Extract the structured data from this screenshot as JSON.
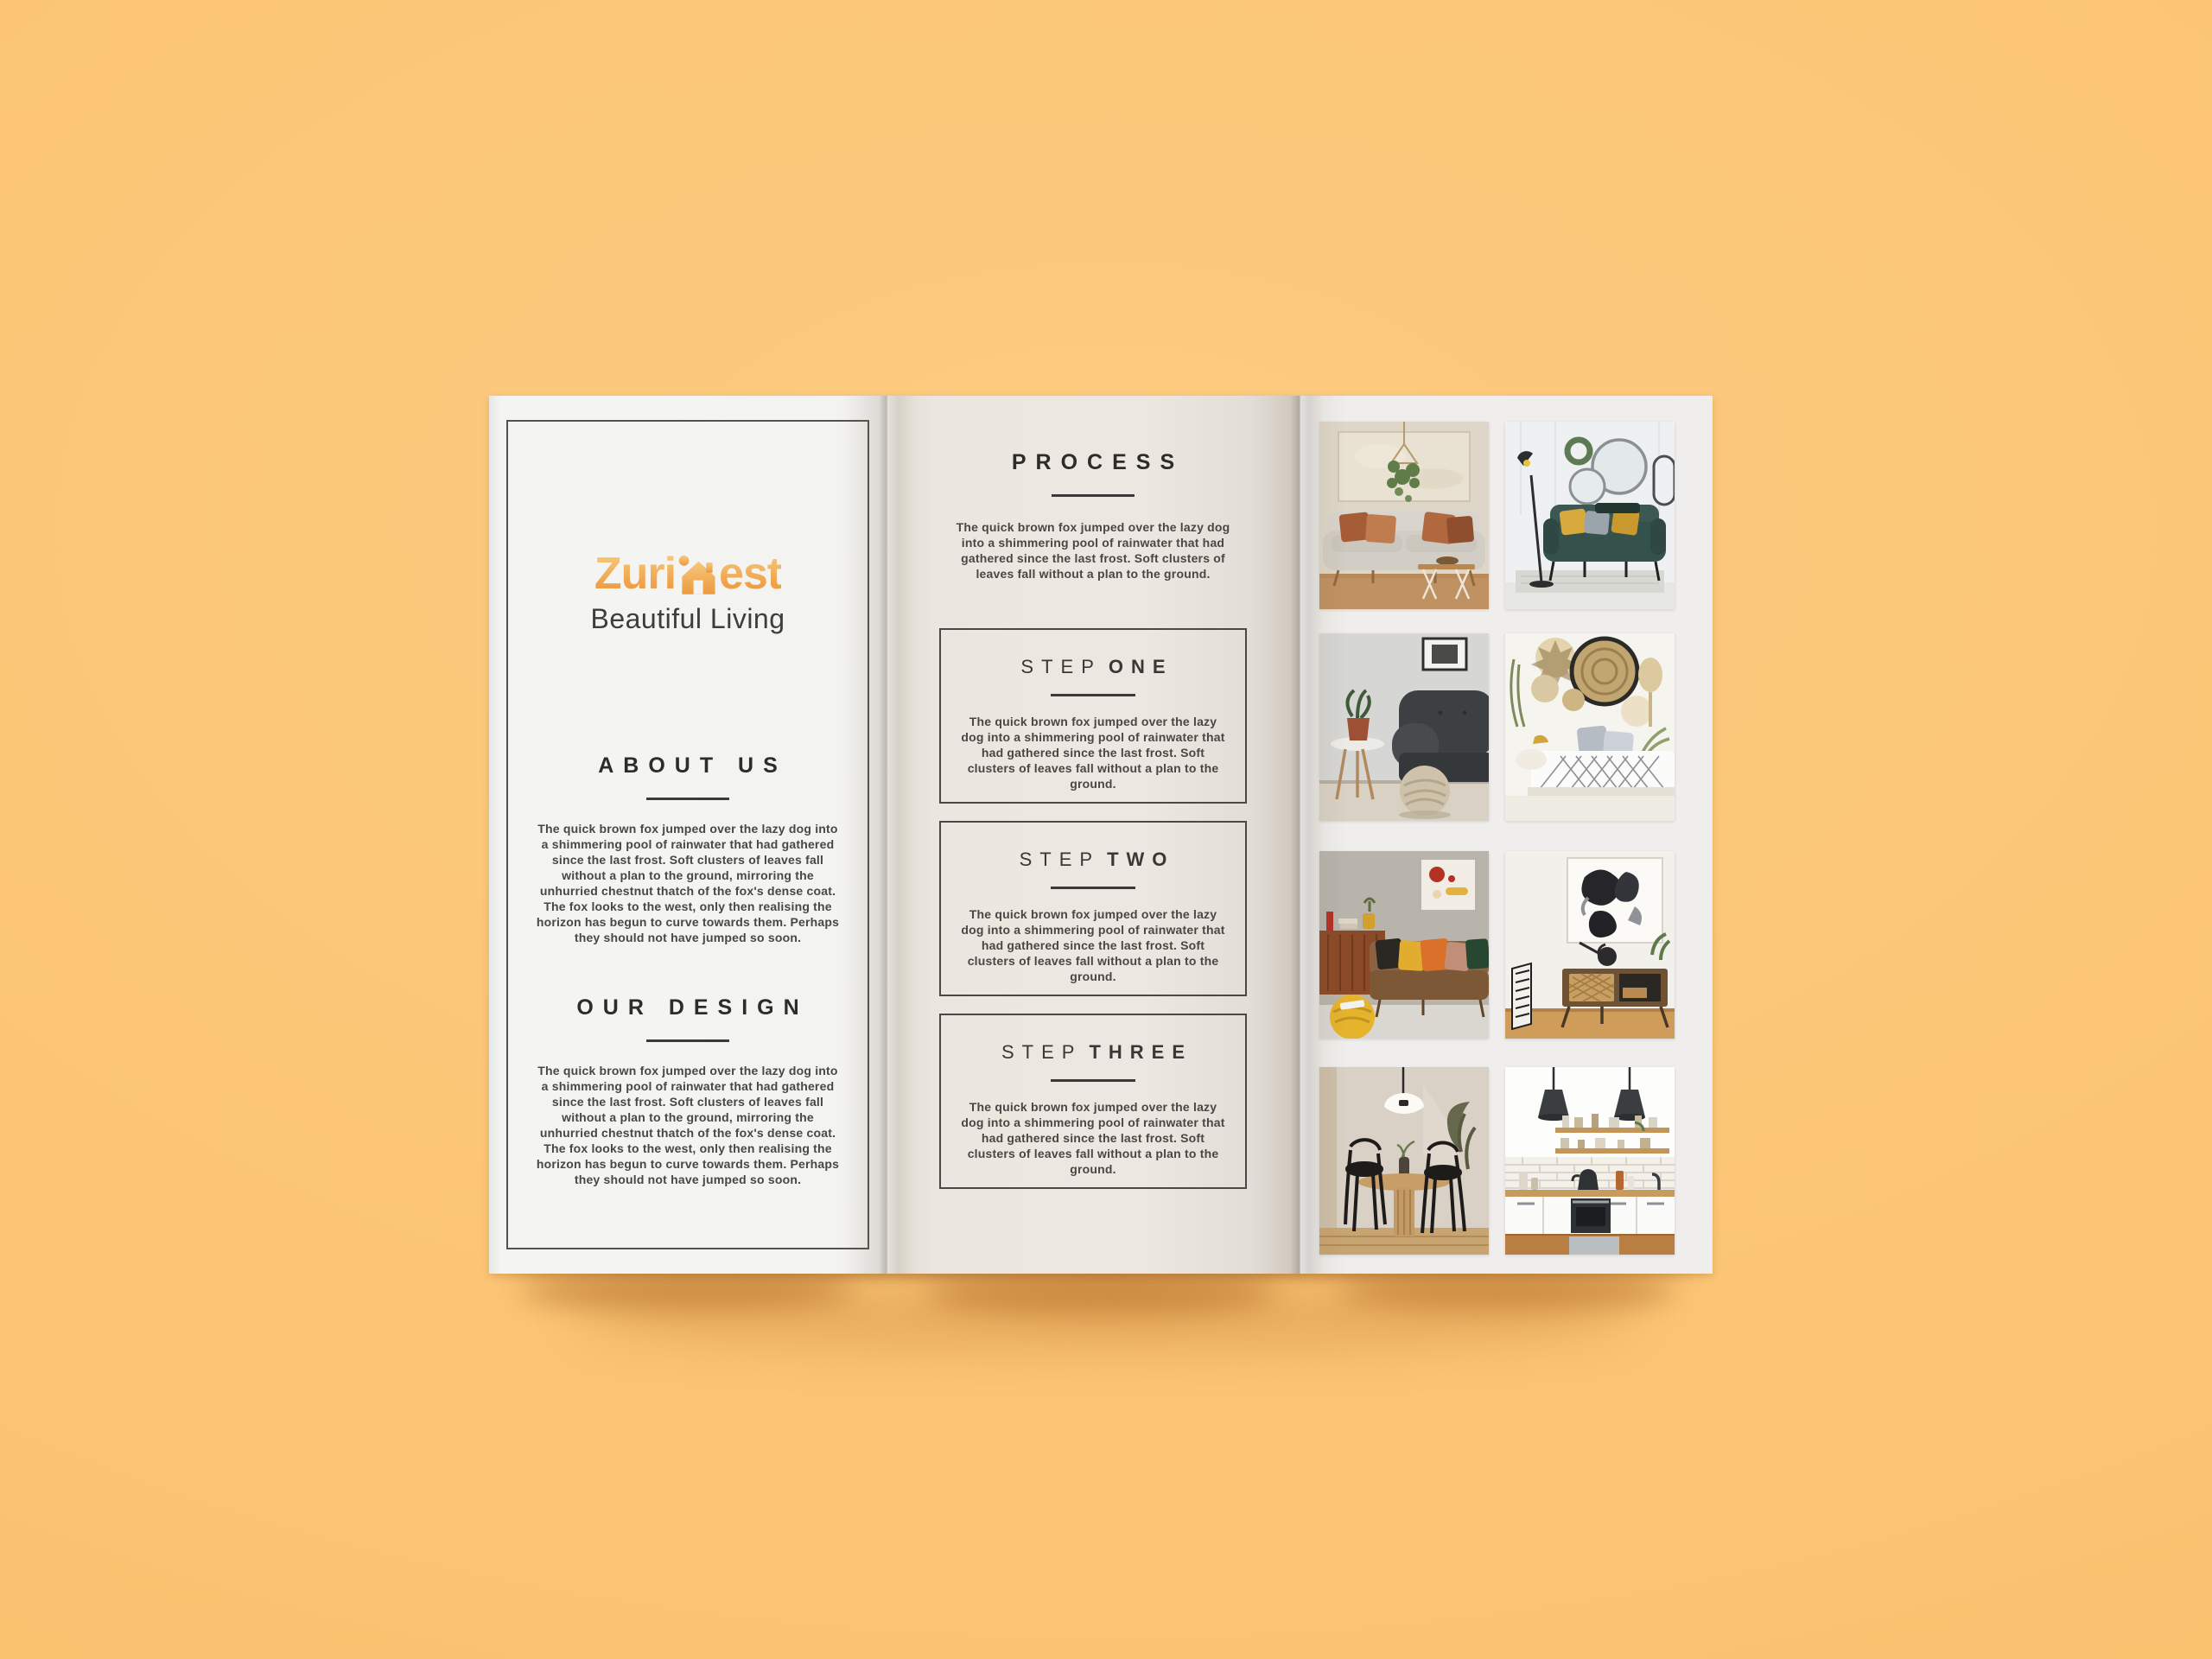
{
  "scene": {
    "description": "Tri-fold interior design brochure mockup lying on an orange surface",
    "background_color": "#fbc473",
    "panel_colors": {
      "cover": "#f3f3f1",
      "process": "#ece8e1",
      "gallery": "#efeeec"
    },
    "accent_color": "#f0a44c"
  },
  "brochure": {
    "cover_panel": {
      "logo": {
        "text_pre": "Zuri",
        "text_post": "est",
        "icon": "house-with-chimney-icon",
        "color_top": "#f7c97e",
        "color_bottom": "#ec9a3e"
      },
      "tagline": "Beautiful Living",
      "sections": [
        {
          "title": "ABOUT US",
          "body": "The quick brown fox jumped over the lazy dog into a shimmering pool of rainwater that had gathered since the last frost. Soft clusters of leaves fall without a plan to the ground, mirroring the unhurried chestnut thatch of the fox's dense coat. The fox looks to the west, only then realising the horizon has begun to curve towards them. Perhaps they should not have jumped so soon."
        },
        {
          "title": "OUR DESIGN",
          "body": "The quick brown fox jumped over the lazy dog into a shimmering pool of rainwater that had gathered since the last frost. Soft clusters of leaves fall without a plan to the ground, mirroring the unhurried chestnut thatch of the fox's dense coat. The fox looks to the west, only then realising the horizon has begun to curve towards them. Perhaps they should not have jumped so soon."
        }
      ]
    },
    "process_panel": {
      "title": "PROCESS",
      "intro": "The quick brown fox jumped over the lazy dog into a shimmering pool of rainwater that had gathered since the last frost. Soft clusters of leaves fall without a plan to the ground.",
      "steps": [
        {
          "label_light": "STEP",
          "label_bold": "ONE",
          "body": "The quick brown fox jumped over the lazy dog into a shimmering pool of rainwater that had gathered since the last frost. Soft clusters of leaves fall without a plan to the ground."
        },
        {
          "label_light": "STEP",
          "label_bold": "TWO",
          "body": "The quick brown fox jumped over the lazy dog into a shimmering pool of rainwater that had gathered since the last frost. Soft clusters of leaves fall without a plan to the ground."
        },
        {
          "label_light": "STEP",
          "label_bold": "THREE",
          "body": "The quick brown fox jumped over the lazy dog into a shimmering pool of rainwater that had gathered since the last frost. Soft clusters of leaves fall without a plan to the ground."
        }
      ]
    },
    "gallery_panel": {
      "photos": [
        {
          "subject": "light sofa with terracotta cushions, beige wall art and hanging plant"
        },
        {
          "subject": "dark green sofa with mustard cushions, round wall mirrors and black floor lamp"
        },
        {
          "subject": "charcoal sofa with knitted pouf, potted plant on side table and framed art"
        },
        {
          "subject": "woven rattan wall baskets above daybed with grey pillows and diamond throw"
        },
        {
          "subject": "brown leather sofa with colourful cushions, wooden sideboard and yellow pouf"
        },
        {
          "subject": "black and white abstract painting above mid-century rattan media console"
        },
        {
          "subject": "round wooden dining table with two black bentwood chairs and white pendant lamp"
        },
        {
          "subject": "white kitchen with subway tiles, wooden counter and two dark pendant lamps"
        }
      ]
    }
  }
}
